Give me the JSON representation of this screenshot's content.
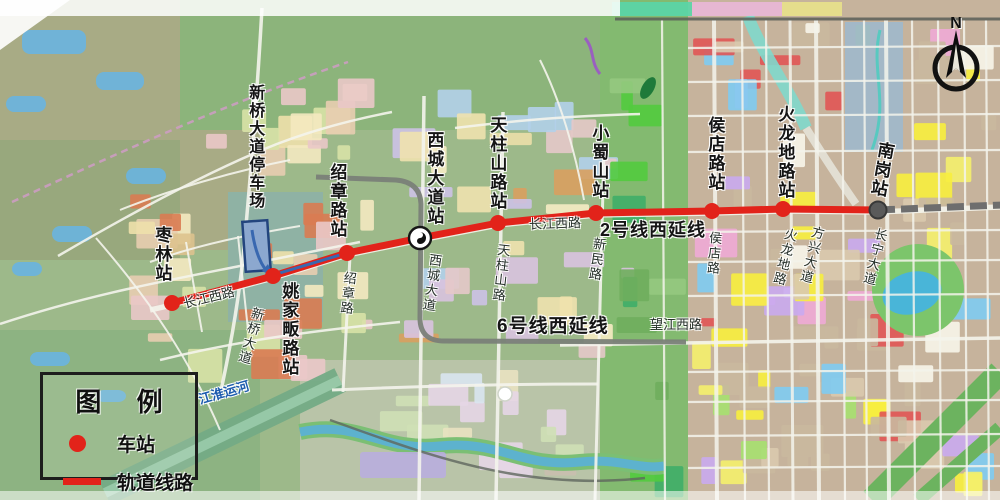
{
  "compass": {
    "label": "N"
  },
  "legend": {
    "title": "图 例",
    "items": [
      {
        "symbol": "station-dot",
        "label": "车站"
      },
      {
        "symbol": "rail-line",
        "label": "轨道线路"
      }
    ]
  },
  "lines": {
    "line2_extension": {
      "label": "2号线西延线",
      "color": "#e2231a",
      "label_x": 600,
      "label_y": 221
    },
    "line2_existing": {
      "color": "#6e6e6e"
    },
    "line6_extension": {
      "label": "6号线西延线",
      "color": "#7a8078",
      "label_x": 497,
      "label_y": 317
    },
    "depot_link": {
      "color": "#3968b0"
    }
  },
  "stations": [
    {
      "name": "枣林站",
      "x": 172,
      "y": 303,
      "marker": "dot",
      "label": {
        "x": 152,
        "y": 226,
        "rot": 0
      }
    },
    {
      "name": "姚家畈路站",
      "x": 273,
      "y": 276,
      "marker": "dot",
      "label": {
        "x": 279,
        "y": 282,
        "rot": 0
      }
    },
    {
      "name": "绍章路站",
      "x": 347,
      "y": 253,
      "marker": "dot",
      "label": {
        "x": 327,
        "y": 163,
        "rot": 0
      }
    },
    {
      "name": "西城大道站",
      "x": 420,
      "y": 238,
      "marker": "metro-logo",
      "label": {
        "x": 424,
        "y": 131,
        "rot": 0
      }
    },
    {
      "name": "天柱山路站",
      "x": 498,
      "y": 223,
      "marker": "dot",
      "label": {
        "x": 487,
        "y": 116,
        "rot": 0
      }
    },
    {
      "name": "小蜀山站",
      "x": 596,
      "y": 213,
      "marker": "dot",
      "label": {
        "x": 589,
        "y": 124,
        "rot": 0
      }
    },
    {
      "name": "侯店路站",
      "x": 712,
      "y": 211,
      "marker": "dot",
      "label": {
        "x": 705,
        "y": 116,
        "rot": 0
      }
    },
    {
      "name": "火龙地路站",
      "x": 783,
      "y": 209,
      "marker": "dot",
      "label": {
        "x": 775,
        "y": 105,
        "rot": 0
      }
    },
    {
      "name": "南岗站",
      "x": 878,
      "y": 210,
      "marker": "terminus",
      "label": {
        "x": 871,
        "y": 141,
        "rot": 10
      }
    }
  ],
  "depot": {
    "name": "新桥大道停车场",
    "label": {
      "x": 246,
      "y": 84,
      "rot": 0
    },
    "rect": {
      "x": 244,
      "y": 221,
      "w": 25,
      "h": 50,
      "rot": -4
    }
  },
  "road_labels": [
    {
      "text": "长江西路",
      "x": 183,
      "y": 291,
      "rot": -14,
      "mode": "h"
    },
    {
      "text": "长江西路",
      "x": 529,
      "y": 217,
      "rot": -2,
      "mode": "h"
    },
    {
      "text": "望江西路",
      "x": 650,
      "y": 318,
      "rot": 0,
      "mode": "h"
    },
    {
      "text": "新桥大道",
      "x": 243,
      "y": 306,
      "rot": 16,
      "mode": "v"
    },
    {
      "text": "绍章路",
      "x": 340,
      "y": 271,
      "rot": 6,
      "mode": "v"
    },
    {
      "text": "西城大道",
      "x": 424,
      "y": 253,
      "rot": 8,
      "mode": "v"
    },
    {
      "text": "天柱山路",
      "x": 493,
      "y": 243,
      "rot": 6,
      "mode": "v"
    },
    {
      "text": "新民路",
      "x": 589,
      "y": 237,
      "rot": 8,
      "mode": "v"
    },
    {
      "text": "侯店路",
      "x": 706,
      "y": 231,
      "rot": 4,
      "mode": "v"
    },
    {
      "text": "火龙地路",
      "x": 777,
      "y": 227,
      "rot": 14,
      "mode": "v"
    },
    {
      "text": "方兴大道",
      "x": 804,
      "y": 225,
      "rot": 14,
      "mode": "v"
    },
    {
      "text": "长宁大道",
      "x": 867,
      "y": 227,
      "rot": 14,
      "mode": "v"
    },
    {
      "text": "江淮运河",
      "x": 198,
      "y": 386,
      "rot": -16,
      "mode": "h",
      "color": "#1d5cae",
      "bold": true
    }
  ]
}
